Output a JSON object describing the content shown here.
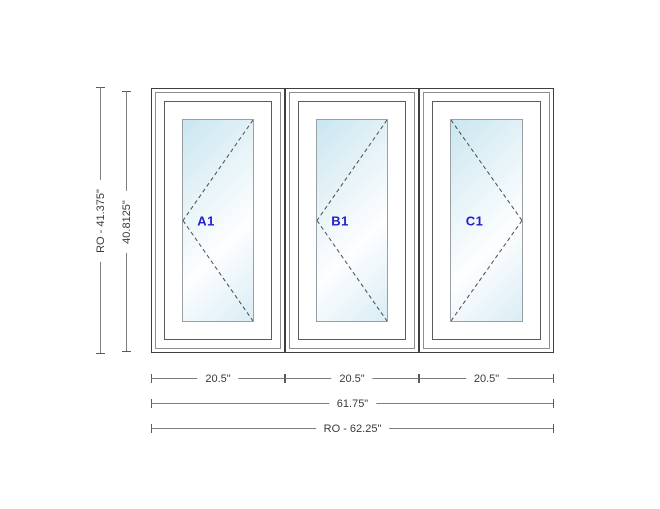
{
  "drawing": {
    "type": "window-configuration-drawing",
    "panels": [
      {
        "label": "A1",
        "swing_hinge": "right",
        "swing_vertex": "left",
        "width_label": "20.5\""
      },
      {
        "label": "B1",
        "swing_hinge": "right",
        "swing_vertex": "left",
        "width_label": "20.5\""
      },
      {
        "label": "C1",
        "swing_hinge": "left",
        "swing_vertex": "right",
        "width_label": "20.5\""
      }
    ],
    "dimensions": {
      "rough_opening_height": {
        "label": "RO - 41.375\""
      },
      "frame_height": {
        "label": "40.8125\""
      },
      "panel_widths": [
        {
          "label": "20.5\""
        },
        {
          "label": "20.5\""
        },
        {
          "label": "20.5\""
        }
      ],
      "frame_width": {
        "label": "61.75\""
      },
      "rough_opening_width": {
        "label": "RO - 62.25\""
      }
    },
    "colors": {
      "panel_label_blue": "#2121cc",
      "frame_line_dark": "#3f3f3f",
      "frame_line_light": "#8e8e8e",
      "glass_tint": "#c9e6f0",
      "dimension_line": "#7d7d7d",
      "dimension_text": "#3a3a3a",
      "background": "#ffffff"
    }
  }
}
